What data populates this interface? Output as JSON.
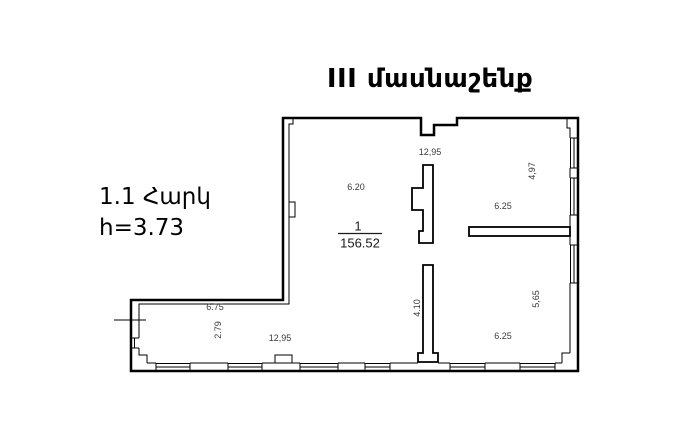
{
  "header": {
    "title": "III մասնաշենք"
  },
  "info": {
    "floor": "1.1 Հարկ",
    "height": "h=3.73"
  },
  "plan": {
    "room": {
      "number": "1",
      "area": "156.52"
    },
    "dimensions": [
      {
        "id": "top-width",
        "text": "12,95"
      },
      {
        "id": "upper-left-width",
        "text": "6.20"
      },
      {
        "id": "upper-right-height",
        "text": "4,97"
      },
      {
        "id": "upper-right-width",
        "text": "6.25"
      },
      {
        "id": "lower-right-height",
        "text": "5,65"
      },
      {
        "id": "lower-right-width",
        "text": "6.25"
      },
      {
        "id": "partition-height",
        "text": "4.10"
      },
      {
        "id": "wing-top-width",
        "text": "6.75"
      },
      {
        "id": "wing-height",
        "text": "2.79"
      },
      {
        "id": "wing-bottom-width",
        "text": "12,95"
      }
    ],
    "colors": {
      "wall": "#000000",
      "dimension_text": "#3a3a3a",
      "background": "#ffffff"
    }
  }
}
